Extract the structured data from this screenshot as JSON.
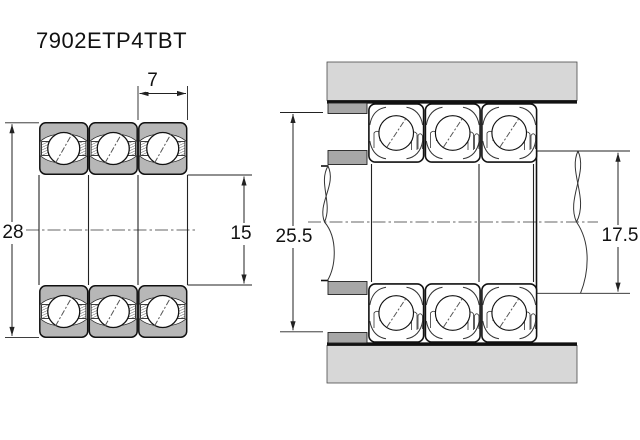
{
  "title": "7902ETP4TBT",
  "dimensions": {
    "bearing_width": "7",
    "outer_diameter": "28",
    "bore_diameter": "15",
    "housing_shoulder_diameter": "25.5",
    "shaft_shoulder_diameter": "17.5"
  },
  "colors": {
    "housing": "#d7d7d7",
    "spacer": "#a7a7a7",
    "ring": "#b7b7b7",
    "line": "#111111"
  }
}
